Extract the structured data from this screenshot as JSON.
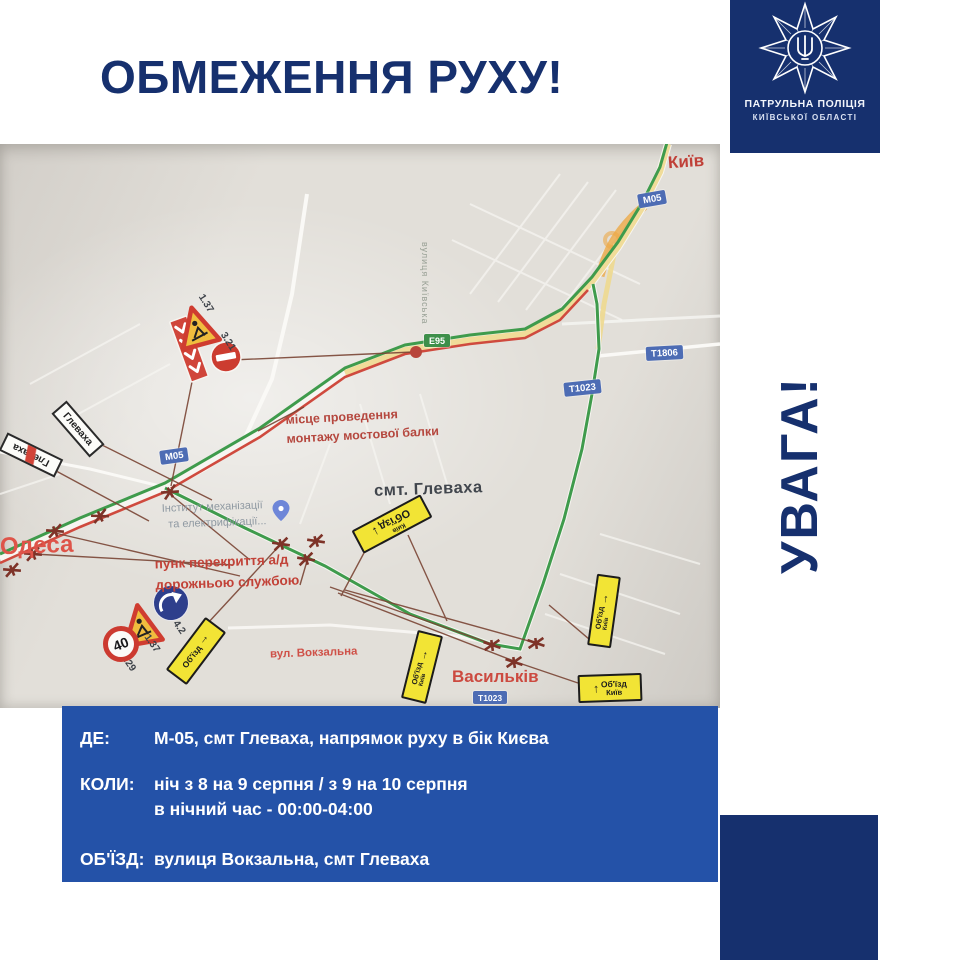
{
  "title": "ОБМЕЖЕННЯ РУХУ!",
  "badge": {
    "org_line1": "ПАТРУЛЬНА ПОЛІЦІЯ",
    "org_line2": "КИЇВСЬКОЇ ОБЛАСТІ"
  },
  "attention": "УВАГА!",
  "map": {
    "labels": {
      "kyiv": "Київ",
      "odesa": "Одеса",
      "vasylkiv": "Васильків",
      "settlement": "смт. Глеваха",
      "street_vokzalna": "вул. Вокзальна",
      "street_kyivska": "вулиця Київська",
      "town_sign": "Глеваха",
      "note_bridge_line1": "місце проведення",
      "note_bridge_line2": "монтажу мостової балки",
      "note_closure_line1": "пунк перекриття а/д",
      "note_closure_line2": "дорожньою службою",
      "poi_line1": "Інститут механізації",
      "poi_line2": "та електрифікації..."
    },
    "road_badges": {
      "m05": "М05",
      "e95": "Е95",
      "t1806": "Т1806",
      "t1023": "Т1023"
    },
    "detour_signs": {
      "detour": "Об'їзд",
      "kyiv": "Київ",
      "arrow_up": "↑",
      "arrow_down": "↓"
    },
    "sign_codes": {
      "roadworks": "1.37",
      "no_entry": "3.21",
      "speed_limit": "3.29",
      "direction": "4.2",
      "speed_value": "40"
    }
  },
  "info": {
    "rows": [
      {
        "label": "ДЕ:",
        "value": "М-05, смт Глеваха, напрямок руху в бік Києва"
      },
      {
        "label": "КОЛИ:",
        "value": "ніч з 8 на 9 серпня / з 9 на 10 серпня",
        "value2": "в нічний час - 00:00-04:00"
      },
      {
        "label": "ОБ'ЇЗД:",
        "value": "вулиця Вокзальна, смт Глеваха"
      }
    ]
  },
  "colors": {
    "navy": "#16306e",
    "panel_blue": "#2452a8",
    "route_green": "#3f9b4c",
    "route_red": "#cf4a3e",
    "road_yellow": "#eed98f",
    "sign_yellow": "#f2e435",
    "label_red": "#c8423a"
  }
}
